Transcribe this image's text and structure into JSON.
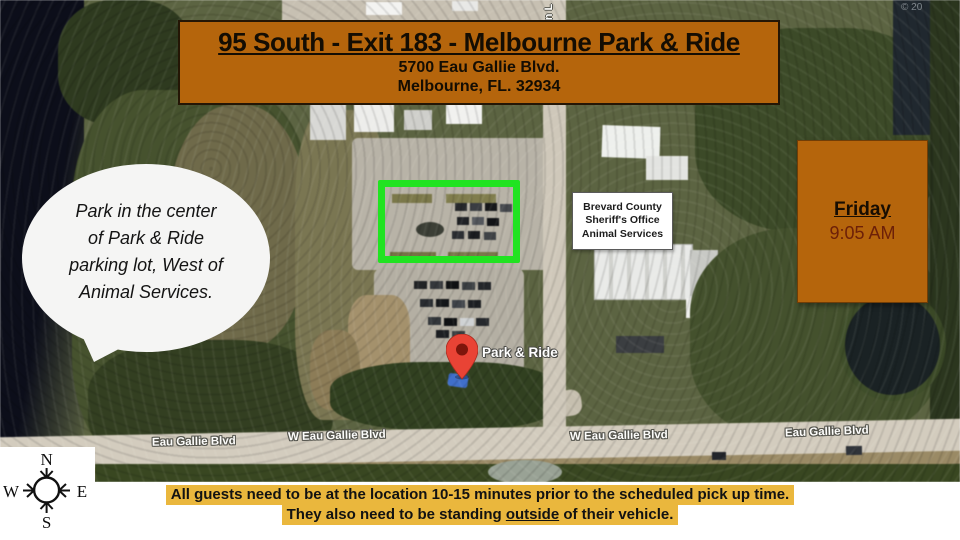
{
  "banner": {
    "title": "95 South - Exit 183 - Melbourne Park & Ride",
    "address_line1": "5700 Eau Gallie Blvd.",
    "address_line2": "Melbourne, FL. 32934"
  },
  "callout": {
    "lines": [
      "Park in the center",
      "of Park & Ride",
      "parking lot, West of",
      "Animal Services."
    ]
  },
  "schedule": {
    "day": "Friday",
    "time": "9:05 AM"
  },
  "map": {
    "poi_lines": [
      "Brevard County",
      "Sheriff's Office",
      "Animal Services"
    ],
    "pin_label": "Park & Ride",
    "road_labels": [
      "Eau Gallie Blvd",
      "W Eau Gallie Blvd",
      "W Eau Gallie Blvd",
      "Eau Gallie Blvd"
    ],
    "vertical_road_fragment": "on L",
    "attribution": "© 20"
  },
  "compass": {
    "north": "N",
    "south": "S",
    "east": "E",
    "west": "W"
  },
  "footer": {
    "line1": "All guests need to be at the location 10-15 minutes prior to the scheduled pick up time.",
    "line2_prefix": "They also need to be standing ",
    "line2_underlined": "outside",
    "line2_suffix": " of their vehicle."
  },
  "colors": {
    "banner_bg": "#b5650c",
    "highlight_yellow": "#eab73d",
    "parking_box_green": "#21e321",
    "pin_red": "#e94335",
    "time_text": "#6d2008"
  }
}
